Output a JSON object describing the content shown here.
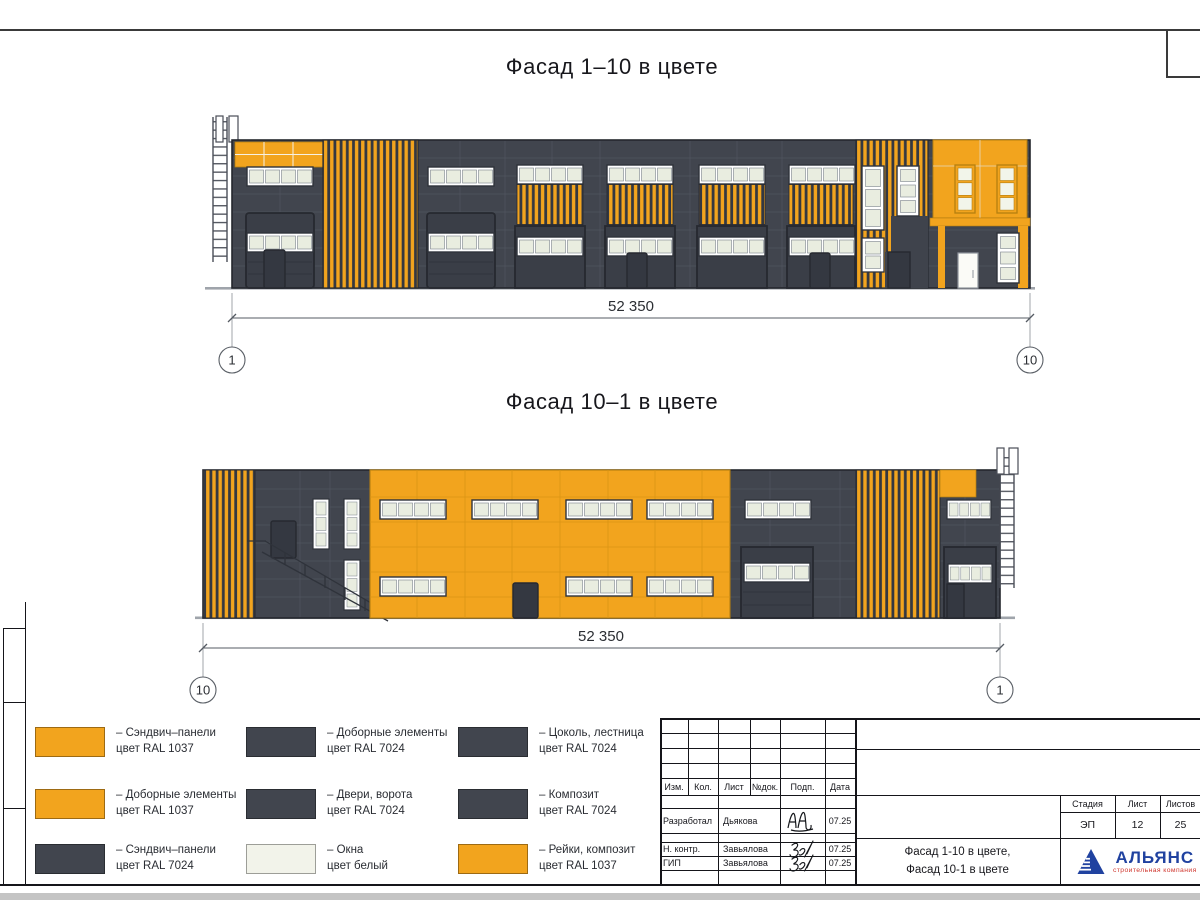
{
  "colors": {
    "panel_orange": "#F2A41E",
    "panel_dark": "#41454E",
    "window_white": "#EEF1E6",
    "logo_blue": "#2042A0",
    "logo_red": "#D03830"
  },
  "facade1": {
    "title": "Фасад 1–10 в цвете",
    "dimension": "52 350",
    "axis_left": "1",
    "axis_right": "10"
  },
  "facade2": {
    "title": "Фасад 10–1 в цвете",
    "dimension": "52 350",
    "axis_left": "10",
    "axis_right": "1"
  },
  "legend": {
    "items": [
      {
        "color": "#F2A41E",
        "line1": "– Сэндвич–панели",
        "line2": "цвет RAL 1037"
      },
      {
        "color": "#F2A41E",
        "line1": "– Доборные элементы",
        "line2": "цвет RAL 1037"
      },
      {
        "color": "#41454E",
        "line1": "– Сэндвич–панели",
        "line2": "цвет RAL 7024"
      },
      {
        "color": "#41454E",
        "line1": "– Доборные элементы",
        "line2": "цвет RAL 7024"
      },
      {
        "color": "#41454E",
        "line1": "– Двери, ворота",
        "line2": "цвет RAL 7024"
      },
      {
        "color": "#F2F3EA",
        "line1": "– Окна",
        "line2": "цвет белый"
      },
      {
        "color": "#41454E",
        "line1": "– Цоколь, лестница",
        "line2": "цвет RAL 7024"
      },
      {
        "color": "#41454E",
        "line1": "– Композит",
        "line2": "цвет RAL 7024"
      },
      {
        "color": "#F2A41E",
        "line1": "– Рейки, композит",
        "line2": "цвет RAL 1037"
      }
    ]
  },
  "stamp": {
    "headers": [
      "Изм.",
      "Кол.",
      "Лист",
      "№док.",
      "Подп.",
      "Дата"
    ],
    "rows": [
      {
        "role": "Разработал",
        "name": "Дьякова",
        "date": "07.25"
      },
      {
        "role": "Н. контр.",
        "name": "Завьялова",
        "date": "07.25"
      },
      {
        "role": "ГИП",
        "name": "Завьялова",
        "date": "07.25"
      }
    ],
    "stage_label": "Стадия",
    "sheet_label": "Лист",
    "sheets_label": "Листов",
    "stage_value": "ЭП",
    "sheet_value": "12",
    "sheets_value": "25",
    "doc_name_line1": "Фасад 1-10 в цвете,",
    "doc_name_line2": "Фасад 10-1 в цвете",
    "logo_name": "АЛЬЯНС",
    "logo_sub": "строительная компания"
  }
}
